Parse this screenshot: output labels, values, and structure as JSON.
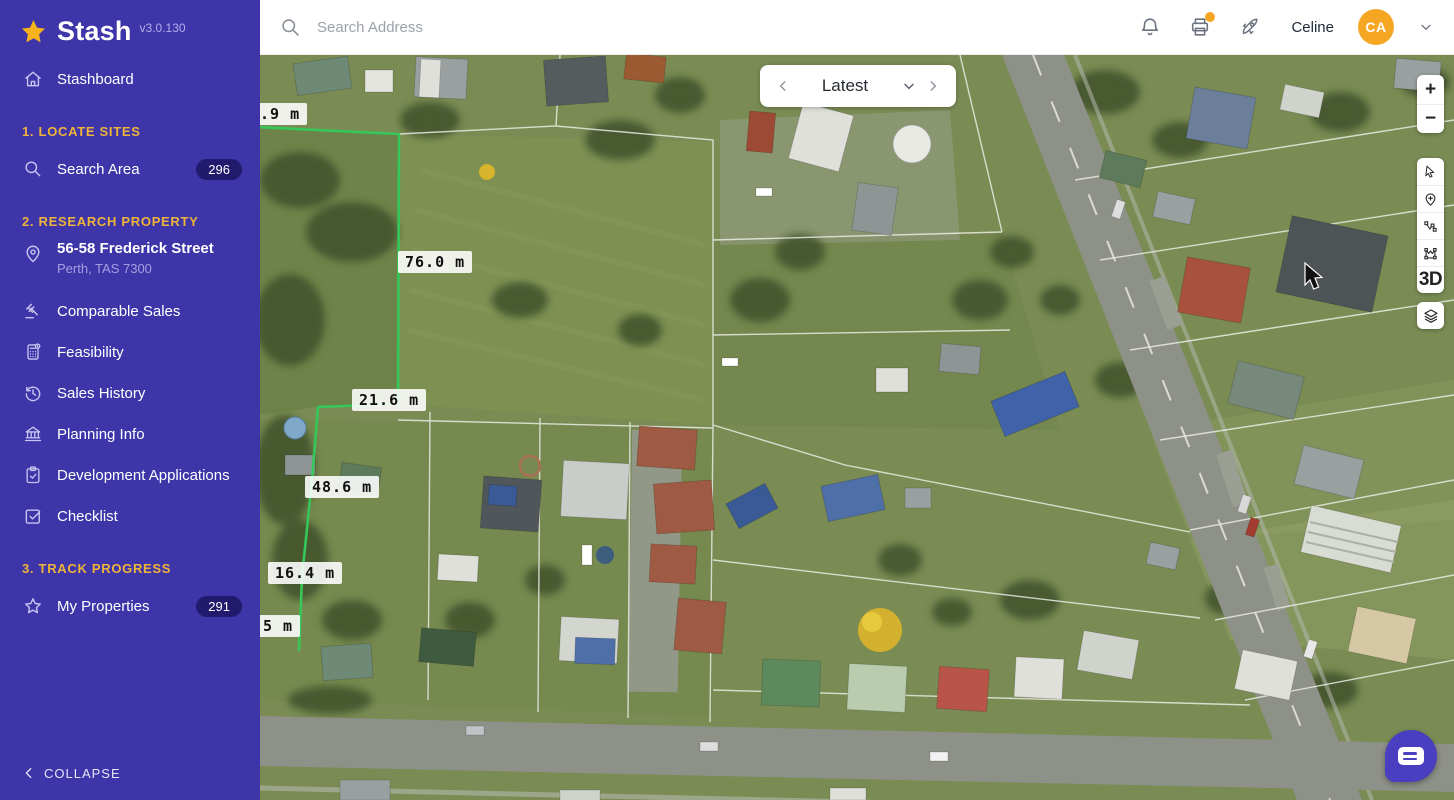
{
  "app": {
    "name": "Stash",
    "version": "v3.0.130"
  },
  "topbar": {
    "search_placeholder": "Search Address",
    "user_name": "Celine",
    "user_initials": "CA"
  },
  "sidebar": {
    "stashboard": "Stashboard",
    "sections": {
      "one": "1. LOCATE SITES",
      "two": "2. RESEARCH PROPERTY",
      "three": "3. TRACK PROGRESS"
    },
    "search_area": {
      "label": "Search Area",
      "badge": "296"
    },
    "property": {
      "address": "56-58 Frederick Street",
      "locality": "Perth, TAS 7300"
    },
    "comparable_sales": "Comparable Sales",
    "feasibility": "Feasibility",
    "sales_history": "Sales History",
    "planning_info": "Planning Info",
    "development_applications": "Development Applications",
    "checklist": "Checklist",
    "my_properties": {
      "label": "My Properties",
      "badge": "291"
    },
    "collapse": "COLLAPSE"
  },
  "map": {
    "timeline": {
      "selected": "Latest"
    },
    "controls": {
      "zoom_in": "+",
      "zoom_out": "−",
      "mode_3d": "3D"
    },
    "measurements": [
      {
        "label": ".9 m"
      },
      {
        "label": "76.0 m"
      },
      {
        "label": "21.6 m"
      },
      {
        "label": "48.6 m"
      },
      {
        "label": "16.4 m"
      },
      {
        "label": "5 m"
      }
    ]
  },
  "colors": {
    "sidebar_purple": "#3E35A9",
    "section_gold": "#EFB43A",
    "avatar_orange": "#F5A623",
    "boundary_green": "#35C759",
    "chat_purple": "#4A3FC0"
  }
}
